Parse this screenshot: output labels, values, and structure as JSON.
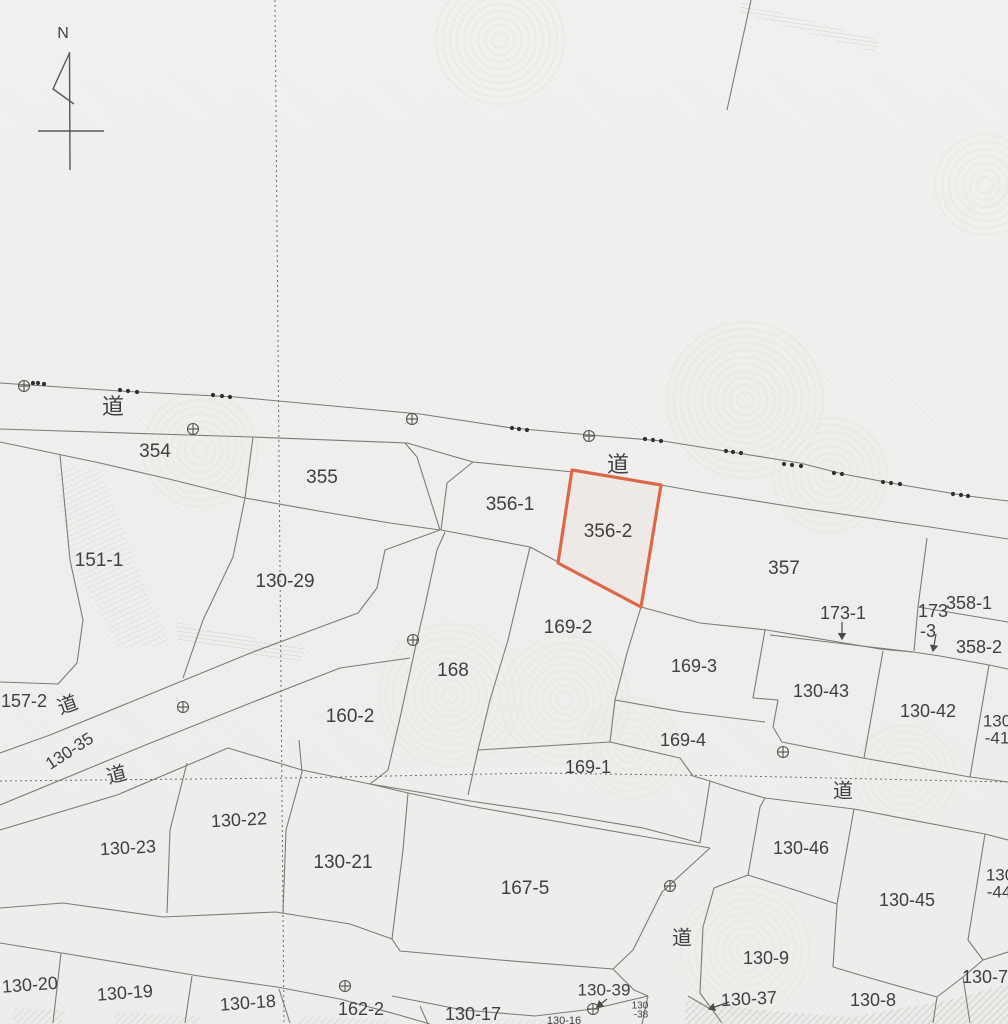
{
  "map": {
    "title": "cadastral-parcel-map",
    "compass": {
      "label": "N"
    },
    "colors": {
      "background": "#f1f0ee",
      "boundary": "#7d7b78",
      "label": "#3f3f3f",
      "highlight": "#d9694a",
      "dotted": "#6f6d6a",
      "marker": "#555350",
      "watermark": "#e9e8e4",
      "hatch": "#8a8884"
    },
    "highlight_parcel": {
      "number": "356-2",
      "path": "M572,470 L661,485 L641,607 L558,563 Z"
    },
    "labels": [
      {
        "text": "道",
        "x": 113,
        "y": 408,
        "fs": 22,
        "rot": 0,
        "kind": "road"
      },
      {
        "text": "354",
        "x": 155,
        "y": 452,
        "fs": 19,
        "rot": 0,
        "kind": "parcel"
      },
      {
        "text": "355",
        "x": 322,
        "y": 478,
        "fs": 19,
        "rot": 0,
        "kind": "parcel"
      },
      {
        "text": "356-1",
        "x": 510,
        "y": 505,
        "fs": 19,
        "rot": 0,
        "kind": "parcel"
      },
      {
        "text": "道",
        "x": 618,
        "y": 466,
        "fs": 22,
        "rot": 0,
        "kind": "road"
      },
      {
        "text": "356-2",
        "x": 608,
        "y": 532,
        "fs": 19,
        "rot": 0,
        "kind": "parcel"
      },
      {
        "text": "357",
        "x": 784,
        "y": 569,
        "fs": 19,
        "rot": 0,
        "kind": "parcel"
      },
      {
        "text": "151-1",
        "x": 99,
        "y": 561,
        "fs": 19,
        "rot": 0,
        "kind": "parcel"
      },
      {
        "text": "130-29",
        "x": 285,
        "y": 582,
        "fs": 19,
        "rot": 0,
        "kind": "parcel"
      },
      {
        "text": "173-1",
        "x": 843,
        "y": 614,
        "fs": 18,
        "rot": 0,
        "kind": "parcel"
      },
      {
        "text": "173",
        "x": 933,
        "y": 612,
        "fs": 18,
        "rot": 0,
        "kind": "parcel"
      },
      {
        "text": "-3",
        "x": 928,
        "y": 632,
        "fs": 18,
        "rot": 0,
        "kind": "parcel"
      },
      {
        "text": "358-1",
        "x": 969,
        "y": 604,
        "fs": 18,
        "rot": 0,
        "kind": "parcel"
      },
      {
        "text": "358-2",
        "x": 979,
        "y": 648,
        "fs": 18,
        "rot": 0,
        "kind": "parcel"
      },
      {
        "text": "169-2",
        "x": 568,
        "y": 628,
        "fs": 19,
        "rot": 0,
        "kind": "parcel"
      },
      {
        "text": "168",
        "x": 453,
        "y": 671,
        "fs": 19,
        "rot": 0,
        "kind": "parcel"
      },
      {
        "text": "169-3",
        "x": 694,
        "y": 667,
        "fs": 18,
        "rot": 0,
        "kind": "parcel"
      },
      {
        "text": "157-2",
        "x": 24,
        "y": 702,
        "fs": 18,
        "rot": 0,
        "kind": "parcel"
      },
      {
        "text": "道",
        "x": 68,
        "y": 706,
        "fs": 20,
        "rot": -20,
        "kind": "road"
      },
      {
        "text": "130-43",
        "x": 821,
        "y": 692,
        "fs": 18,
        "rot": 0,
        "kind": "parcel"
      },
      {
        "text": "130-42",
        "x": 928,
        "y": 712,
        "fs": 18,
        "rot": 0,
        "kind": "parcel"
      },
      {
        "text": "130",
        "x": 997,
        "y": 722,
        "fs": 17,
        "rot": 0,
        "kind": "parcel"
      },
      {
        "text": "-41",
        "x": 997,
        "y": 739,
        "fs": 17,
        "rot": 0,
        "kind": "parcel"
      },
      {
        "text": "160-2",
        "x": 350,
        "y": 717,
        "fs": 19,
        "rot": 0,
        "kind": "parcel"
      },
      {
        "text": "130-35",
        "x": 70,
        "y": 752,
        "fs": 17,
        "rot": -33,
        "kind": "parcel"
      },
      {
        "text": "道",
        "x": 117,
        "y": 776,
        "fs": 20,
        "rot": -15,
        "kind": "road"
      },
      {
        "text": "169-4",
        "x": 683,
        "y": 741,
        "fs": 18,
        "rot": 0,
        "kind": "parcel"
      },
      {
        "text": "169-1",
        "x": 588,
        "y": 768,
        "fs": 18,
        "rot": 0,
        "kind": "parcel"
      },
      {
        "text": "道",
        "x": 843,
        "y": 792,
        "fs": 20,
        "rot": 0,
        "kind": "road"
      },
      {
        "text": "130-22",
        "x": 239,
        "y": 821,
        "fs": 18,
        "rot": -3,
        "kind": "parcel"
      },
      {
        "text": "130-23",
        "x": 128,
        "y": 849,
        "fs": 18,
        "rot": -3,
        "kind": "parcel"
      },
      {
        "text": "130-21",
        "x": 343,
        "y": 863,
        "fs": 19,
        "rot": 0,
        "kind": "parcel"
      },
      {
        "text": "130-46",
        "x": 801,
        "y": 849,
        "fs": 18,
        "rot": 0,
        "kind": "parcel"
      },
      {
        "text": "167-5",
        "x": 525,
        "y": 889,
        "fs": 19,
        "rot": 0,
        "kind": "parcel"
      },
      {
        "text": "130-45",
        "x": 907,
        "y": 901,
        "fs": 18,
        "rot": 0,
        "kind": "parcel"
      },
      {
        "text": "130",
        "x": 1000,
        "y": 876,
        "fs": 17,
        "rot": 0,
        "kind": "parcel"
      },
      {
        "text": "-44",
        "x": 999,
        "y": 893,
        "fs": 17,
        "rot": 0,
        "kind": "parcel"
      },
      {
        "text": "道",
        "x": 682,
        "y": 939,
        "fs": 20,
        "rot": 0,
        "kind": "road"
      },
      {
        "text": "130-9",
        "x": 766,
        "y": 959,
        "fs": 18,
        "rot": 0,
        "kind": "parcel"
      },
      {
        "text": "130-7",
        "x": 985,
        "y": 978,
        "fs": 18,
        "rot": 0,
        "kind": "parcel"
      },
      {
        "text": "130-20",
        "x": 30,
        "y": 986,
        "fs": 18,
        "rot": -4,
        "kind": "parcel"
      },
      {
        "text": "130-19",
        "x": 125,
        "y": 994,
        "fs": 18,
        "rot": -4,
        "kind": "parcel"
      },
      {
        "text": "130-39",
        "x": 604,
        "y": 991,
        "fs": 17,
        "rot": 0,
        "kind": "parcel"
      },
      {
        "text": "130-37",
        "x": 749,
        "y": 1000,
        "fs": 18,
        "rot": -3,
        "kind": "parcel"
      },
      {
        "text": "130-18",
        "x": 248,
        "y": 1004,
        "fs": 18,
        "rot": -4,
        "kind": "parcel"
      },
      {
        "text": "130-8",
        "x": 873,
        "y": 1001,
        "fs": 18,
        "rot": 0,
        "kind": "parcel"
      },
      {
        "text": "162-2",
        "x": 361,
        "y": 1010,
        "fs": 18,
        "rot": 0,
        "kind": "parcel"
      },
      {
        "text": "130-17",
        "x": 473,
        "y": 1015,
        "fs": 18,
        "rot": 0,
        "kind": "parcel"
      },
      {
        "text": "130-16",
        "x": 564,
        "y": 1021,
        "fs": 11,
        "rot": 0,
        "kind": "parcel"
      },
      {
        "text": "130",
        "x": 640,
        "y": 1006,
        "fs": 10,
        "rot": 0,
        "kind": "parcel"
      },
      {
        "text": "-38",
        "x": 641,
        "y": 1015,
        "fs": 10,
        "rot": 0,
        "kind": "parcel"
      }
    ],
    "boundaries": [
      "M0,383 L120,391 235,397 420,414 512,428 590,435 663,441 725,451 800,463 843,474 902,485 968,496 1008,501",
      "M0,429 L253,437 407,443 473,462 573,472",
      "M661,485 L700,492 800,508 930,527 1008,539",
      "M253,437 L245,498",
      "M0,442 L100,463 173,480 245,498",
      "M245,498 L330,513 390,523 440,530",
      "M405,443 L417,457 428,492 440,530",
      "M473,462 L447,483 441,530",
      "M441,530 L530,547 558,562",
      "M245,498 L233,557 203,620 183,678",
      "M60,455 L70,560 83,620 77,663 58,684 0,682",
      "M0,753 L50,735 143,697 253,652 358,613",
      "M0,805 L143,746 253,702 340,668 410,658",
      "M0,830 L117,795 228,748 302,770 370,784",
      "M440,530 L385,550 377,588 358,613",
      "M445,532 L437,550 424,610 417,640 400,718 388,770 370,784",
      "M187,763 L170,830 167,913",
      "M299,740 L302,772 286,830 283,913",
      "M0,908 L63,903 163,917 276,912 350,924 392,939 400,951 500,960 613,969",
      "M0,943 L68,954 199,976 277,987 340,999 399,1015 430,1024",
      "M61,953 L53,1023",
      "M192,976 L185,1023",
      "M279,989 L290,1023",
      "M420,1006 L428,1024",
      "M641,607 L700,623 767,630 880,649 913,652",
      "M770,635 L845,644 913,652",
      "M913,652 L940,656 989,665 1008,669",
      "M927,538 L918,607 914,651",
      "M918,607 L1008,622",
      "M641,607 L627,653 615,700",
      "M615,700 L683,712 765,722",
      "M530,547 L508,640 490,700 478,750 468,795",
      "M478,750 L610,742",
      "M615,700 L610,742",
      "M610,742 L680,758 693,776 710,781",
      "M408,793 L470,806 560,822 710,848",
      "M370,784 L430,794 470,801 560,814 643,828 700,843",
      "M370,784 L408,793 403,850 398,890 392,939",
      "M710,848 L662,892 633,950 613,969",
      "M710,781 L700,843",
      "M710,781 L737,790 765,798",
      "M765,798 L760,807 748,875 714,888 703,927 700,993 722,1023",
      "M688,996 L712,1010",
      "M392,996 L463,1010 535,1016 593,1009 648,996",
      "M613,969 L634,990 648,996",
      "M648,996 L642,1024",
      "M765,630 L753,698 778,700 773,727 782,742",
      "M883,651 L864,758",
      "M782,742 L863,758 970,777 1008,782",
      "M989,665 L970,777",
      "M765,798 L854,809 985,834 1008,840",
      "M854,809 L837,904 833,967",
      "M748,875 L795,890 837,904",
      "M833,967 L870,978 937,997",
      "M985,834 L968,940 983,960",
      "M937,997 L963,977 983,960 1008,952",
      "M937,997 L933,1023",
      "M963,977 L970,1023",
      "M751,0 L727,110"
    ],
    "dotted_lines": [
      "M275,0 L284,1024",
      "M0,781 L290,778 540,773 740,776 1008,782"
    ],
    "survey_markers": [
      [
        24,
        386
      ],
      [
        193,
        429
      ],
      [
        412,
        419
      ],
      [
        589,
        436
      ],
      [
        183,
        707
      ],
      [
        413,
        640
      ],
      [
        783,
        752
      ],
      [
        670,
        886
      ],
      [
        345,
        986
      ],
      [
        593,
        1009
      ]
    ],
    "boundary_dots": [
      [
        33,
        383
      ],
      [
        38,
        383
      ],
      [
        44,
        384
      ],
      [
        120,
        390
      ],
      [
        128,
        391
      ],
      [
        137,
        392
      ],
      [
        213,
        395
      ],
      [
        222,
        396
      ],
      [
        230,
        397
      ],
      [
        512,
        428
      ],
      [
        519,
        429
      ],
      [
        527,
        430
      ],
      [
        645,
        439
      ],
      [
        653,
        440
      ],
      [
        661,
        441
      ],
      [
        726,
        451
      ],
      [
        733,
        452
      ],
      [
        741,
        453
      ],
      [
        784,
        464
      ],
      [
        792,
        465
      ],
      [
        801,
        466
      ],
      [
        834,
        473
      ],
      [
        842,
        474
      ],
      [
        883,
        482
      ],
      [
        891,
        483
      ],
      [
        900,
        484
      ],
      [
        953,
        494
      ],
      [
        961,
        495
      ],
      [
        968,
        496
      ]
    ],
    "arrows": [
      {
        "from": [
          842,
          622
        ],
        "to": [
          842,
          639
        ]
      },
      {
        "from": [
          936,
          634
        ],
        "to": [
          933,
          651
        ]
      },
      {
        "from": [
          607,
          999
        ],
        "to": [
          597,
          1007
        ]
      },
      {
        "from": [
          729,
          1002
        ],
        "to": [
          709,
          1009
        ]
      }
    ],
    "hatch_patches": [
      {
        "path": "M55,468 L100,470 150,600 170,645 120,648 70,560 Z",
        "pattern": "steep",
        "opacity": 0.22
      },
      {
        "path": "M175,622 L305,648 300,663 178,640 Z",
        "pattern": "flat",
        "opacity": 0.3
      },
      {
        "path": "M742,2 L880,40 874,52 740,13 Z",
        "pattern": "flat",
        "opacity": 0.3
      },
      {
        "path": "M685,1000 L760,1010 850,1017 950,1000 1008,984 1008,1024 685,1024 Z",
        "pattern": "cross",
        "opacity": 0.45
      },
      {
        "path": "M15,1008 L65,1010 62,1024 12,1024 Z",
        "pattern": "cross",
        "opacity": 0.3
      },
      {
        "path": "M115,1012 L200,1016 198,1024 113,1024 Z",
        "pattern": "cross",
        "opacity": 0.3
      },
      {
        "path": "M300,1016 L390,1019 388,1024 298,1024 Z",
        "pattern": "cross",
        "opacity": 0.28
      },
      {
        "path": "M455,1018 L558,1020 556,1024 453,1024 Z",
        "pattern": "cross",
        "opacity": 0.28
      }
    ],
    "watermarks": [
      {
        "x": 500,
        "y": 40,
        "r": 70
      },
      {
        "x": 745,
        "y": 400,
        "r": 80
      },
      {
        "x": 830,
        "y": 475,
        "r": 60
      },
      {
        "x": 450,
        "y": 695,
        "r": 75
      },
      {
        "x": 565,
        "y": 700,
        "r": 70
      },
      {
        "x": 630,
        "y": 748,
        "r": 55
      },
      {
        "x": 745,
        "y": 950,
        "r": 65
      },
      {
        "x": 905,
        "y": 775,
        "r": 55
      },
      {
        "x": 200,
        "y": 450,
        "r": 60
      },
      {
        "x": 985,
        "y": 185,
        "r": 55
      }
    ]
  }
}
